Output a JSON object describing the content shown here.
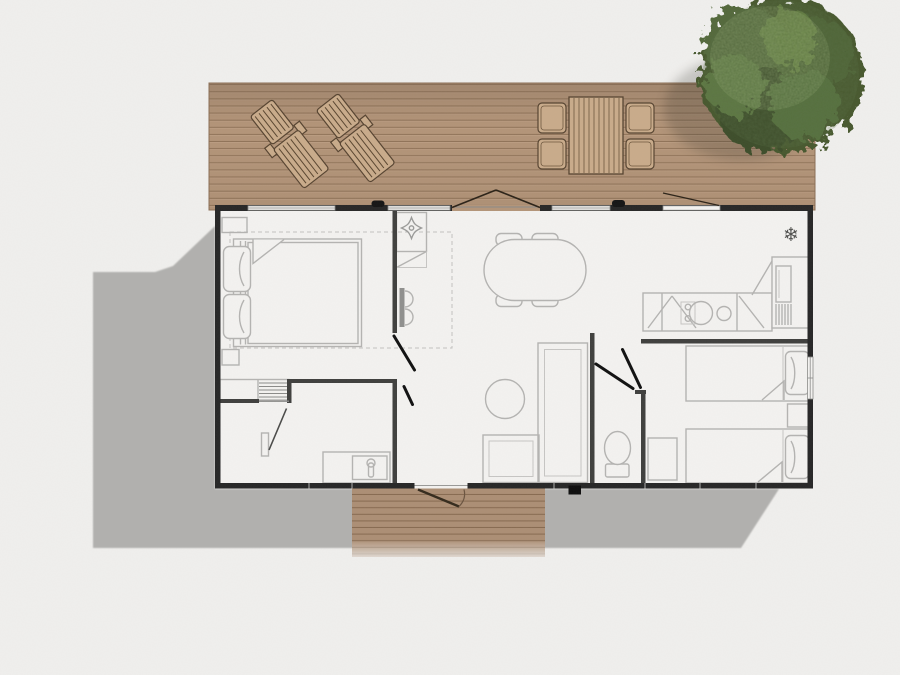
{
  "scene": {
    "kind": "floor-plan-top-view",
    "description": "Mobile-home floor plan with front wooden deck, rear entrance step, drop shadow and a tree at the top right"
  },
  "icons": {
    "snowflake": "❄",
    "vent_star": "four-petal-star"
  },
  "colors": {
    "background": "#f0efed",
    "shadow": "#b1b0ae",
    "deck_wood": "#b39478",
    "deck_plank_line": "#8f7257",
    "porch_wood": "#ac8e74",
    "wall_perimeter": "#262626",
    "wall_interior": "#3f3f3d",
    "floor": "#f3f2f0",
    "furniture_line": "#b4b3b1",
    "door_leaf": "#101010",
    "wood_outline": "#564330",
    "deck_furniture_wood": "#c9ab8a",
    "tree_dark": "#3d4f2a",
    "tree_mid": "#516936",
    "tree_light": "#6f8c49"
  },
  "deck": {
    "items": [
      "sun-lounger",
      "sun-lounger",
      "dining-table",
      "chair",
      "chair",
      "chair",
      "chair",
      "tree"
    ]
  },
  "building": {
    "rooms": [
      {
        "name": "master-bedroom",
        "furniture": [
          "double-bed",
          "pillows",
          "nightstand",
          "nightstand",
          "wardrobe-shelves",
          "dashed-clearance-zone"
        ]
      },
      {
        "name": "bathroom",
        "furniture": [
          "washbasin-counter",
          "faucet",
          "towel-rail",
          "door-swing"
        ]
      },
      {
        "name": "living-room",
        "furniture": [
          "oval-dining-table",
          "four-chairs",
          "l-shaped-sofa",
          "round-coffee-table",
          "entry-cabinet",
          "ceiling-vent-star",
          "wall-unit"
        ]
      },
      {
        "name": "kitchen",
        "furniture": [
          "counter-with-sink",
          "hob-knobs",
          "tall-fridge-unit",
          "snowflake-fridge-icon"
        ]
      },
      {
        "name": "wc",
        "furniture": [
          "toilet",
          "door-swing"
        ]
      },
      {
        "name": "second-bedroom",
        "furniture": [
          "single-bed",
          "single-bed",
          "nightstand",
          "stool-cabinet",
          "door-swing"
        ]
      }
    ],
    "openings": [
      "french-double-door-to-deck",
      "kitchen-window-open",
      "top-windows",
      "right-wall-window",
      "rear-entrance-door-to-step"
    ]
  }
}
